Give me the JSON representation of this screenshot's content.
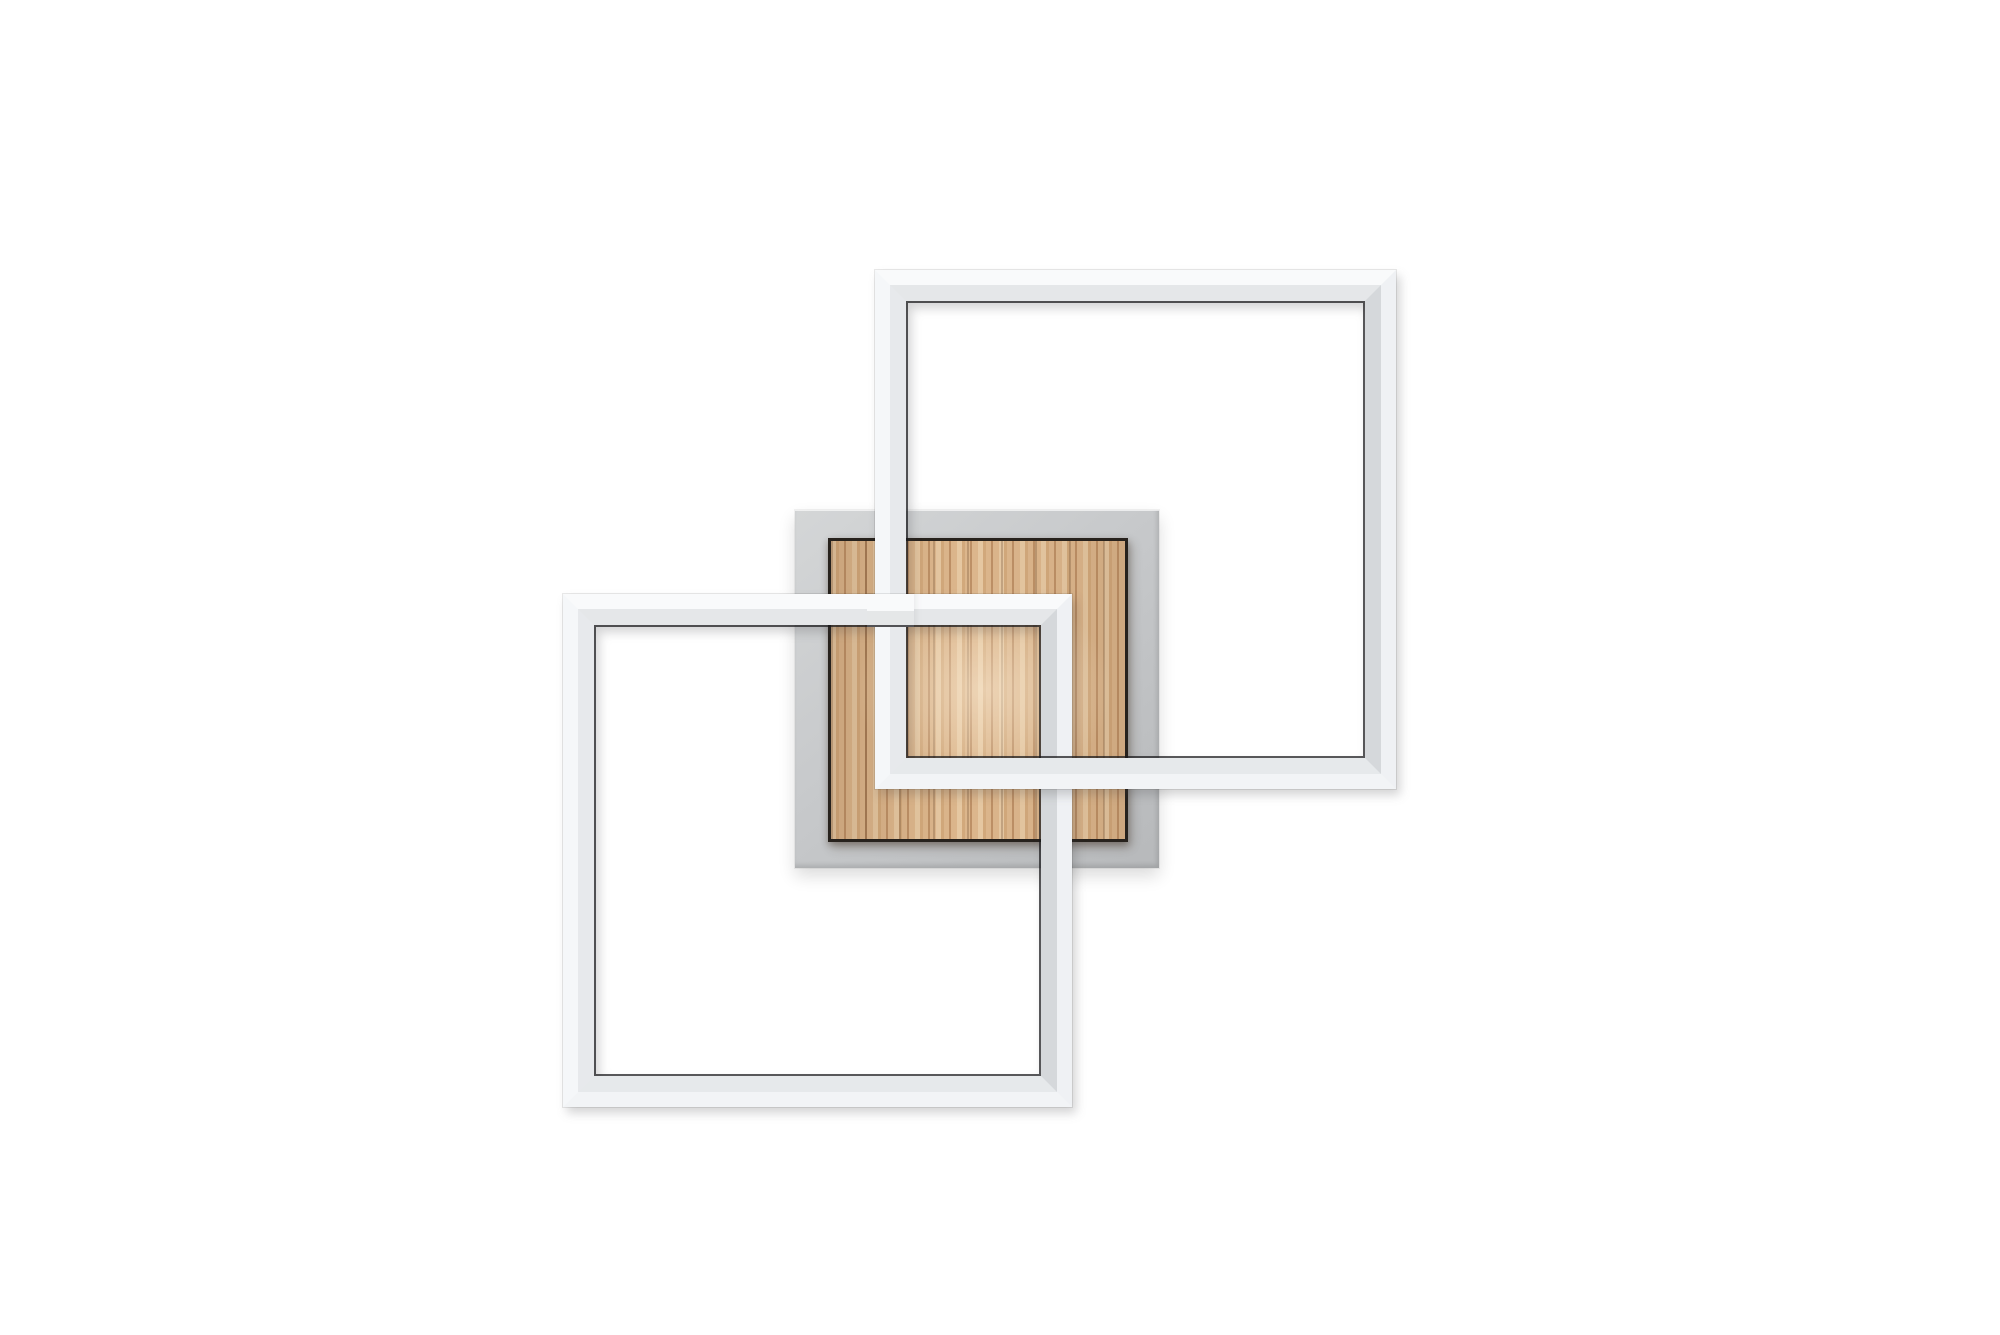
{
  "image_type": "product-photo",
  "subject": "Modern LED ceiling light: two interlocking white square light frames woven around a wood-grain panel on a grey square mounting plate, on a white background",
  "canvas": {
    "width": 2000,
    "height": 1335
  },
  "background_color": "#ffffff",
  "palette": {
    "frame_top": "#f9fafb",
    "frame_left": "#f5f7f9",
    "frame_right": "#eff1f4",
    "frame_bottom": "#f2f4f6",
    "plate_light": "#d4d6d7",
    "plate_mid": "#c7c9cb",
    "plate_dark": "#b7b9bb",
    "wood_light": "#e6c8a2",
    "wood_mid": "#d2a97c",
    "wood_base": "#dcb68c",
    "wood_dark": "#bd9066",
    "wood_border": "#27221d"
  },
  "parts": {
    "backplate": {
      "left": 795,
      "top": 510,
      "width": 364,
      "height": 358
    },
    "wood_panel": {
      "left": 828,
      "top": 538,
      "width": 300,
      "height": 304
    },
    "frame_upper_right": {
      "left": 875,
      "top": 270,
      "width": 521,
      "height": 519,
      "tube_width": 31
    },
    "frame_lower_left": {
      "left": 563,
      "top": 594,
      "width": 509,
      "height": 513,
      "tube_width": 31
    },
    "weave_patch": {
      "left": 867,
      "top": 594,
      "width": 47,
      "height": 33
    }
  }
}
